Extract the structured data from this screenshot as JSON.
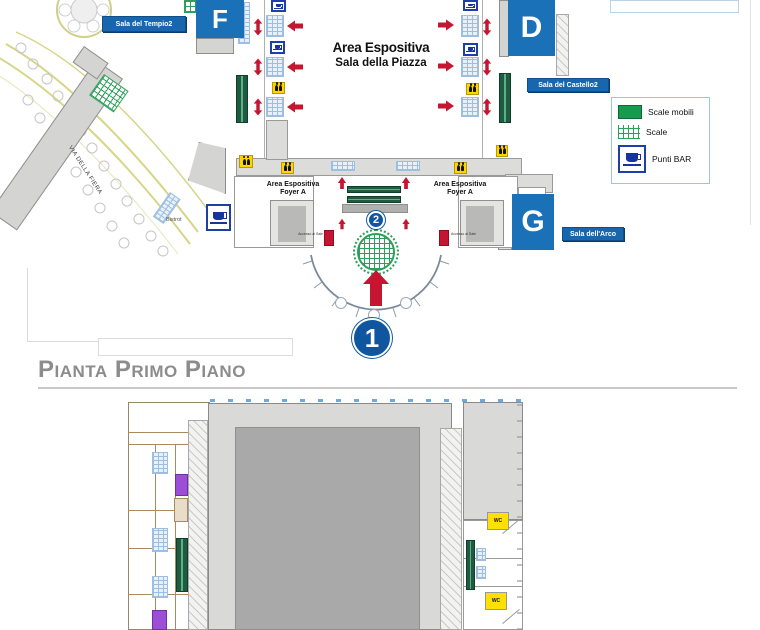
{
  "upper_map": {
    "hall_letters": {
      "f": "F",
      "d": "D",
      "g": "G"
    },
    "room_badges": {
      "tempio": "Sala del Tempio2",
      "castello": "Sala del Castello2",
      "arco": "Sala dell'Arco"
    },
    "center_label": {
      "line1": "Area Espositiva",
      "line2": "Sala della Piazza"
    },
    "foyer_left": {
      "line1": "Area Espositiva",
      "line2": "Foyer A"
    },
    "foyer_right": {
      "line1": "Area Espositiva",
      "line2": "Foyer A"
    },
    "bistrot_label": "Bistrot",
    "street_label": "VIA DELLA FIERA",
    "access_label_left": "Accesso ai Sale",
    "access_label_right": "Accesso ai Sale",
    "entrance_marker": "1",
    "stairs_marker": "2"
  },
  "legend": {
    "items": [
      {
        "id": "escalators",
        "label": "Scale mobili"
      },
      {
        "id": "stairs",
        "label": "Scale"
      },
      {
        "id": "bar",
        "label": "Punti BAR"
      }
    ]
  },
  "section_title": "Pianta Primo Piano",
  "lower_map": {
    "wc_top": "WC",
    "wc_bottom": "WC"
  },
  "colors": {
    "accent_blue": "#1a71b8",
    "badge_blue": "#1766ae",
    "marker_blue": "#0f56a0",
    "arrow_red": "#c41531",
    "legend_green": "#169b4e",
    "stairs_green": "#2ca05a",
    "escalator_green": "#1d5c40",
    "wc_yellow": "#ffd500",
    "purple": "#9c4ed6",
    "road_olive": "#d6d687"
  }
}
